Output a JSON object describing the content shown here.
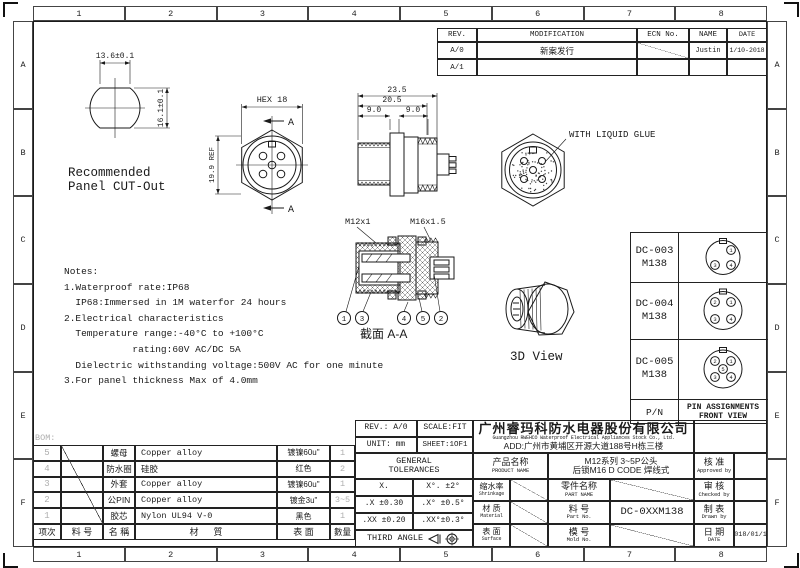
{
  "drawing": {
    "zone_cols": [
      "1",
      "2",
      "3",
      "4",
      "5",
      "6",
      "7",
      "8"
    ],
    "zone_rows": [
      "A",
      "B",
      "C",
      "D",
      "E",
      "F"
    ]
  },
  "revision_table": {
    "headers": {
      "rev": "REV.",
      "modification": "MODIFICATION",
      "ecn": "ECN No.",
      "name": "NAME",
      "date": "DATE"
    },
    "rows": [
      {
        "rev": "A/0",
        "modification": "新案发行",
        "name": "Justin",
        "date": "1/10-2018"
      },
      {
        "rev": "A/1",
        "modification": "",
        "name": "",
        "date": ""
      }
    ]
  },
  "panel_cutout": {
    "dim_width": "13.6±0.1",
    "dim_height": "16.1±0.1",
    "caption1": "Recommended",
    "caption2": "Panel CUT-Out"
  },
  "front_view": {
    "dim_hex": "HEX 18",
    "dim_ref": "19.9 REF",
    "section_a_top": "A",
    "section_a_bottom": "A"
  },
  "side_view": {
    "dim_total": "23.5",
    "dim_mid": "20.5",
    "dim_left": "9.0",
    "dim_right": "9.0"
  },
  "glue_view": {
    "label": "WITH LIQUID GLUE"
  },
  "section_view": {
    "thread_left": "M12x1",
    "thread_right": "M16x1.5",
    "caption": "截面  A-A",
    "balloons": [
      "1",
      "3",
      "4",
      "5",
      "2"
    ]
  },
  "view_3d": {
    "caption": "3D View"
  },
  "notes": {
    "lines": [
      "Notes:",
      "1.Waterproof rate:IP68",
      "  IP68:Immersed in 1M waterfor 24 hours",
      "2.Electrical characteristics",
      "  Temperature range:-40°C to +100°C",
      "            rating:60V AC/DC 5A",
      "  Dielectric withstanding voltage:500V AC for one minute",
      "3.For panel thickness Max of 4.0mm"
    ]
  },
  "pin_table": {
    "rows": [
      {
        "pn": "DC-003",
        "model": "M138",
        "pins": [
          {
            "n": "1"
          },
          {
            "n": "3"
          },
          {
            "n": "4"
          }
        ]
      },
      {
        "pn": "DC-004",
        "model": "M138",
        "pins": [
          {
            "n": "2"
          },
          {
            "n": "1"
          },
          {
            "n": "3"
          },
          {
            "n": "4"
          }
        ]
      },
      {
        "pn": "DC-005",
        "model": "M138",
        "pins": [
          {
            "n": "2"
          },
          {
            "n": "1"
          },
          {
            "n": "5"
          },
          {
            "n": "3"
          },
          {
            "n": "4"
          }
        ]
      }
    ],
    "footer_label": "P/N",
    "footer_title1": "PIN ASSIGNMENTS",
    "footer_title2": "FRONT VIEW"
  },
  "bom": {
    "label": "BOM:",
    "headers": {
      "no": "项次",
      "part_no": "料 号",
      "name": "名 稱",
      "material": "材      質",
      "surface": "表 面",
      "qty": "數量"
    },
    "rows": [
      {
        "no": "5",
        "name": "螺母",
        "material": "Copper alloy",
        "surface": "镀镍60u\"",
        "qty": "1"
      },
      {
        "no": "4",
        "name": "防水圈",
        "material": "硅胶",
        "surface": "红色",
        "qty": "2"
      },
      {
        "no": "3",
        "name": "外套",
        "material": "Copper alloy",
        "surface": "镀镍60u\"",
        "qty": "1"
      },
      {
        "no": "2",
        "name": "公PIN",
        "material": "Copper alloy",
        "surface": "镀金3u\"",
        "qty": "3~5"
      },
      {
        "no": "1",
        "name": "胶芯",
        "material": "Nylon UL94 V-0",
        "surface": "黑色",
        "qty": "1"
      }
    ]
  },
  "title_block": {
    "rev": "REV.: A/0",
    "scale": "SCALE:FIT",
    "unit": "UNIT: mm",
    "sheet": "SHEET:1OF1",
    "company_cn": "广州睿玛科防水电器股份有限公司",
    "company_en": "Guangzhou RWEHCO Waterproof Electrical Appliances Stock Co., Ltd.",
    "address": "ADD:广州市黄埔区开源大道188号H栋三楼",
    "tol_header1": "GENERAL",
    "tol_header2": "TOLERANCES",
    "tol_r1c1": "X.",
    "tol_r1c2": "X°. ±2°",
    "tol_r2c1": ".X ±0.30",
    "tol_r2c2": ".X° ±0.5°",
    "tol_r3c1": ".XX ±0.20",
    "tol_r3c2": ".XX°±0.3°",
    "third_angle": "THIRD ANGLE",
    "product_label_cn": "产品名称",
    "product_label_en": "PRODUCT NAME",
    "product_value1": "M12系列 3~5P公头",
    "product_value2": "后锁M16 D CODE 焊线式",
    "shrinkage_cn": "缩水率",
    "shrinkage_en": "Shrinkage",
    "material_cn": "材 质",
    "material_en": "Material",
    "surface_cn": "表 面",
    "surface_en": "Surface",
    "part_name_cn": "零件名称",
    "part_name_en": "PART NAME",
    "part_no_cn": "料 号",
    "part_no_en": "Part No.",
    "part_no_value": "DC-0XXM138",
    "mold_no_cn": "模 号",
    "mold_no_en": "Mold No.",
    "approved_cn": "核 准",
    "approved_en": "Approved by",
    "checked_cn": "审 核",
    "checked_en": "Checked by",
    "drawn_cn": "制 表",
    "drawn_en": "Drawn by",
    "date_cn": "日 期",
    "date_en": "DATE",
    "date_value": "2018/01/10"
  }
}
